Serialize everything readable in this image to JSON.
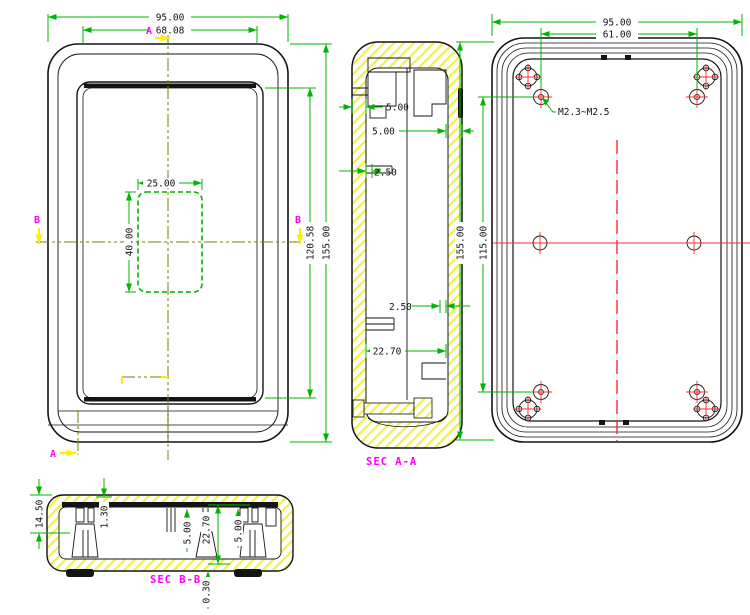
{
  "front_view": {
    "dims": {
      "overall_width": "95.00",
      "opening_width": "68.08",
      "cutout_width": "25.00",
      "cutout_height": "40.00",
      "opening_height": "120.58",
      "overall_height": "155.00"
    },
    "section_markers": {
      "a_top": "A",
      "a_bottom": "A",
      "b_left": "B",
      "b_right": "B"
    }
  },
  "section_a": {
    "label": "SEC A-A",
    "dims": {
      "top_boss": "5.00",
      "side_wall": "5.00",
      "rib_upper": "2.50",
      "rib_lower": "2.50",
      "cavity_depth": "22.70"
    }
  },
  "back_view": {
    "dims": {
      "overall_width": "95.00",
      "boss_span_x": "61.00",
      "overall_height": "155.00",
      "boss_span_y": "115.00"
    },
    "thread_note": "M2.3~M2.5"
  },
  "section_b": {
    "label": "SEC B-B",
    "dims": {
      "total_height": "14.50",
      "lip": "1.30",
      "boss_mid": "5.00",
      "cavity": "22.70",
      "boss_right": "5.00",
      "clearance": "0.30"
    }
  },
  "colors": {
    "dimension_line": "#00b400",
    "section_label": "#ff00ff",
    "view_arrow": "#ffee00",
    "centerline": "#7d7d00",
    "symmetry_line": "#ff2a2a",
    "hatch": "#f5ef3d",
    "outline": "#141414"
  }
}
